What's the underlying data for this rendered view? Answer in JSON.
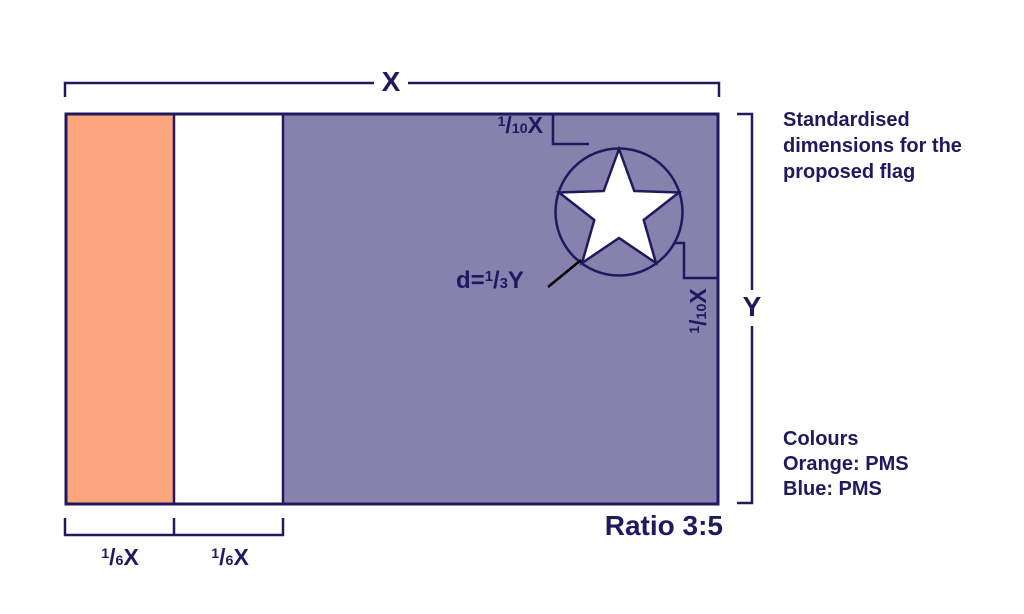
{
  "figure": {
    "caption_lines": [
      "Standardised",
      "dimensions for the",
      "proposed flag"
    ],
    "colours_lines": [
      "Colours",
      "Orange: PMS",
      "Blue: PMS"
    ],
    "ratio_label": "Ratio 3:5"
  },
  "dimensions": {
    "width_label": "X",
    "height_label": "Y",
    "top_offset": {
      "sup": "1",
      "slash": "/",
      "sub": "10",
      "unit": "X"
    },
    "right_offset": {
      "sup": "1",
      "slash": "/",
      "sub": "10",
      "unit": "X"
    },
    "star_diameter": {
      "prefix": "d=",
      "sup": "1",
      "slash": "/",
      "sub": "3",
      "unit": "Y"
    },
    "stripe_widths": [
      {
        "sup": "1",
        "slash": "/",
        "sub": "6",
        "unit": "X"
      },
      {
        "sup": "1",
        "slash": "/",
        "sub": "6",
        "unit": "X"
      }
    ]
  },
  "colors": {
    "orange": "#FDA57D",
    "blue": "#8781AD",
    "navy": "#1F1A5F",
    "star_fill": "#FFFFFF",
    "leader_line": "#000000"
  }
}
